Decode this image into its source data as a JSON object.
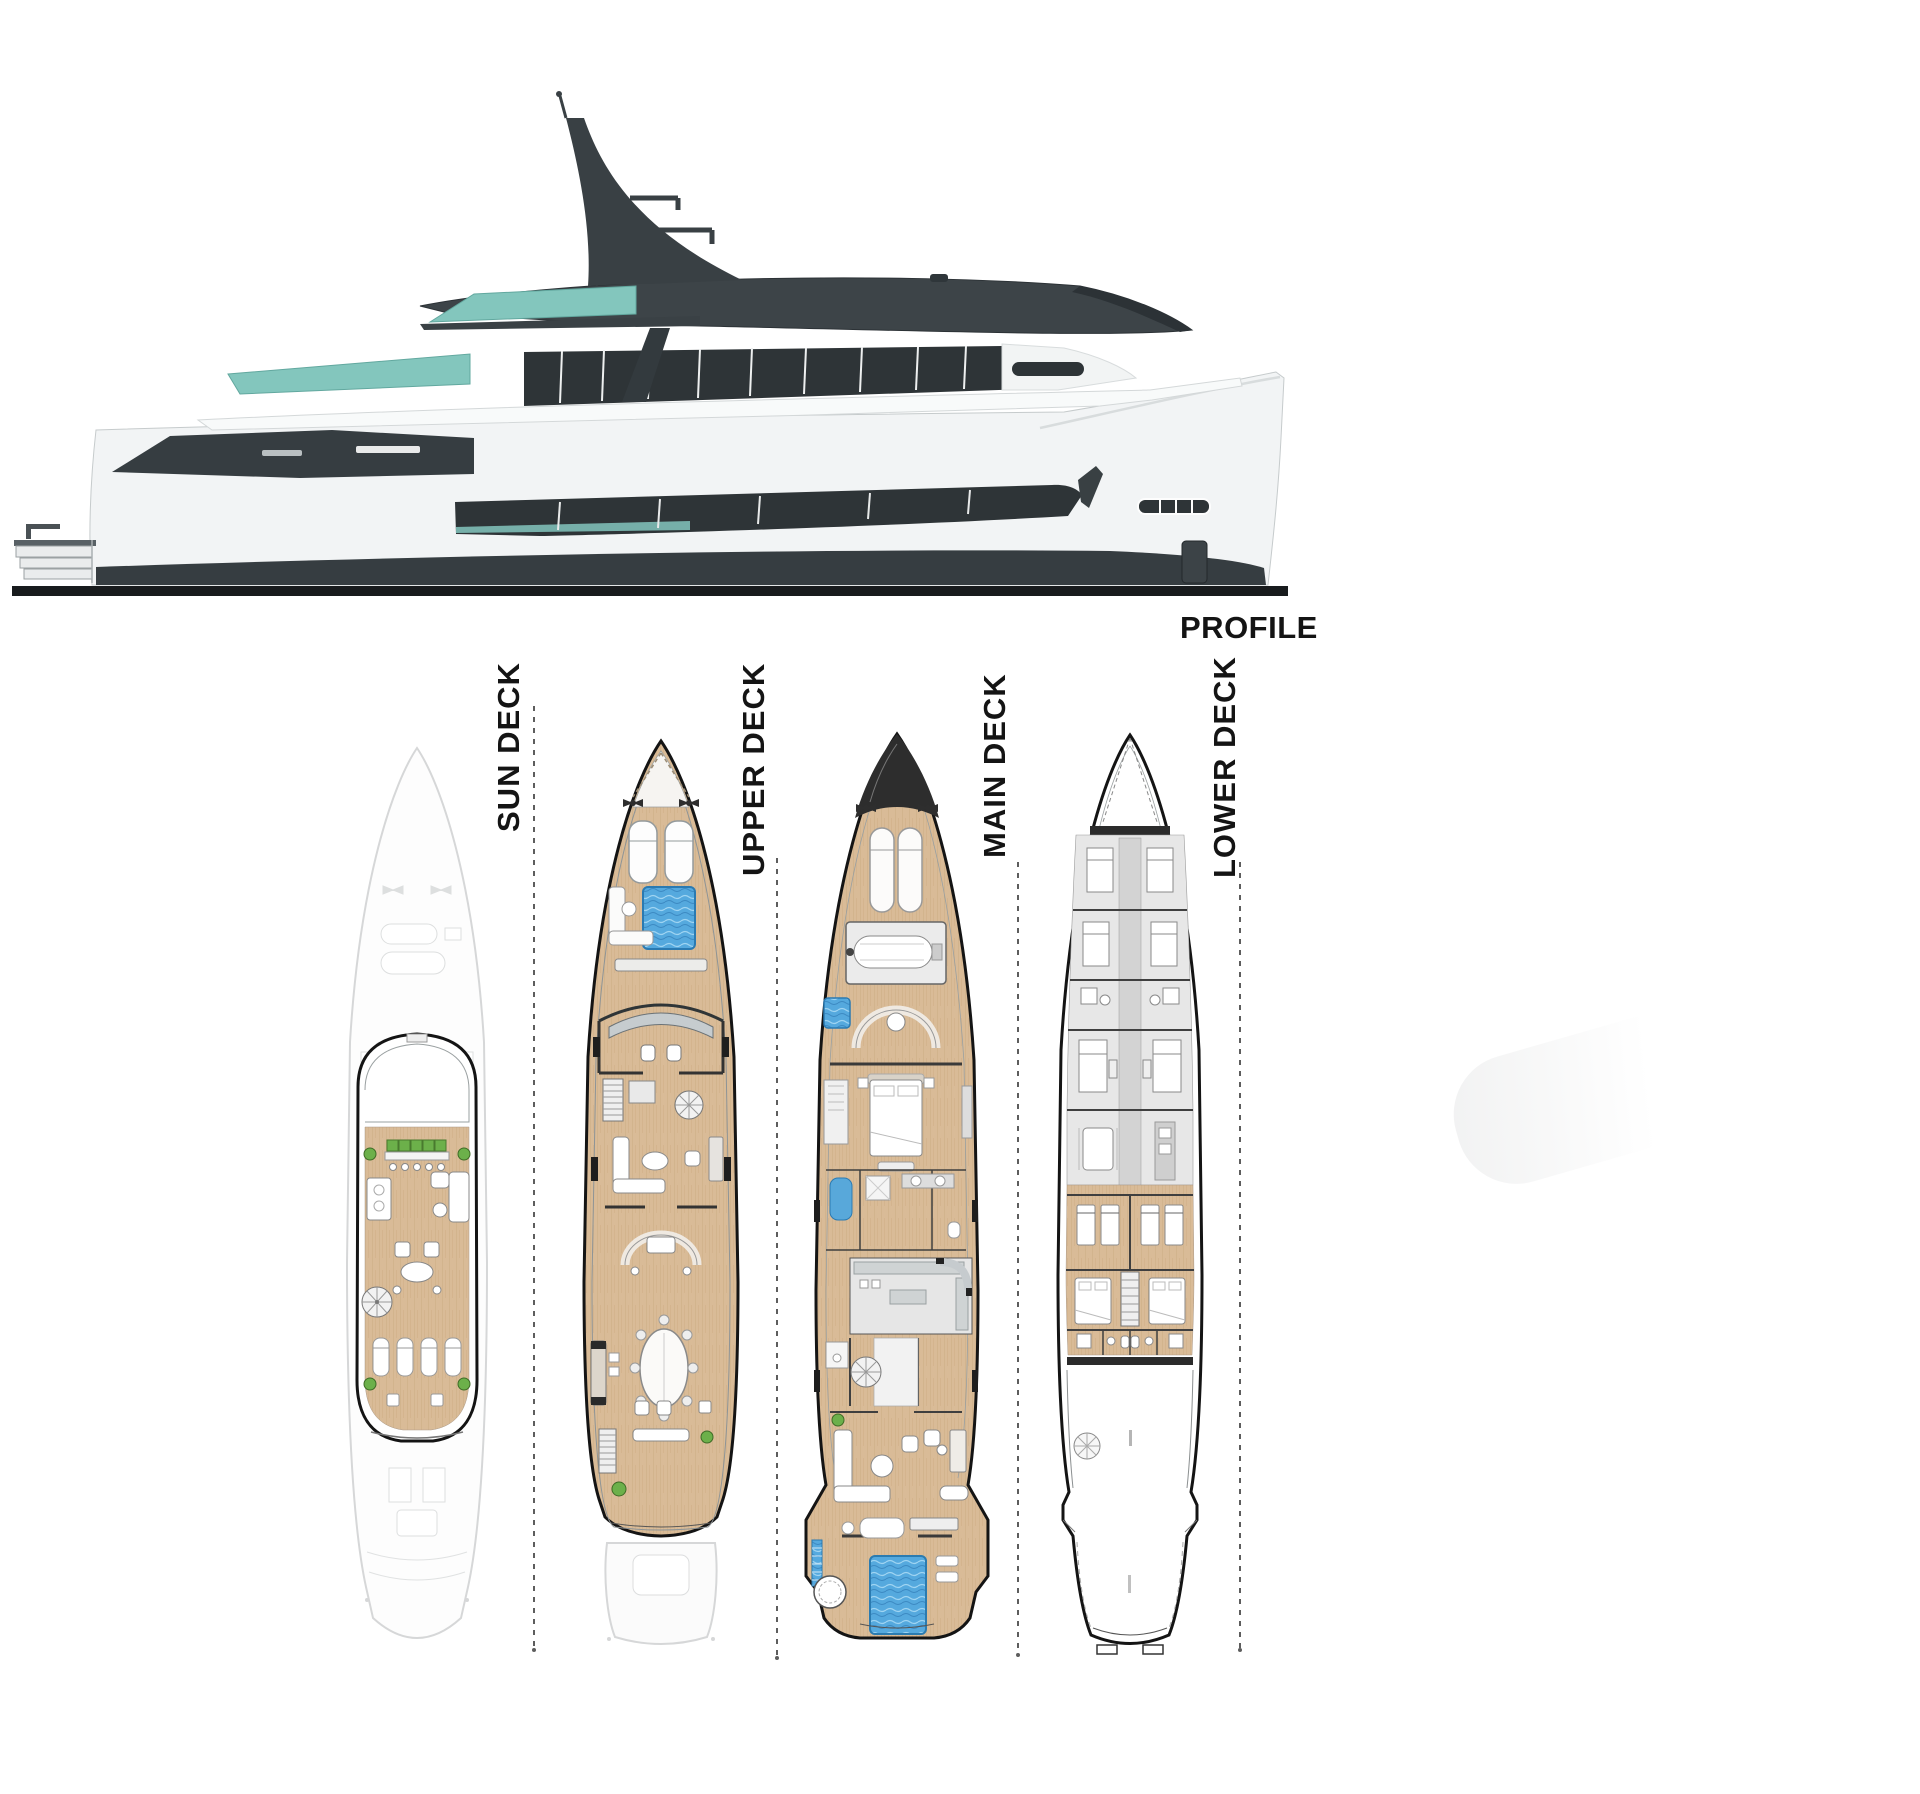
{
  "page": {
    "type": "yacht-general-arrangement-plan",
    "background": "#ffffff"
  },
  "profile_view": {
    "label": "PROFILE"
  },
  "deck_plans": [
    {
      "id": "sun-deck",
      "label": "SUN DECK"
    },
    {
      "id": "upper-deck",
      "label": "UPPER DECK"
    },
    {
      "id": "main-deck",
      "label": "MAIN DECK"
    },
    {
      "id": "lower-deck",
      "label": "LOWER DECK"
    }
  ],
  "colors": {
    "label_text": "#141414",
    "outline": "#141414",
    "superstructure": "#3d4448",
    "glass_dark": "#2e3437",
    "glass_teal": "#83c6bd",
    "hull_white": "#f2f4f5",
    "waterline": "#181b1d",
    "teak": "#d9bb97",
    "teak_line": "#c8a87e",
    "pool_blue": "#55a9de",
    "plant_green": "#6cb04a",
    "crew_floor": "#e7e7e7",
    "ghost": "#bdc0c1"
  }
}
